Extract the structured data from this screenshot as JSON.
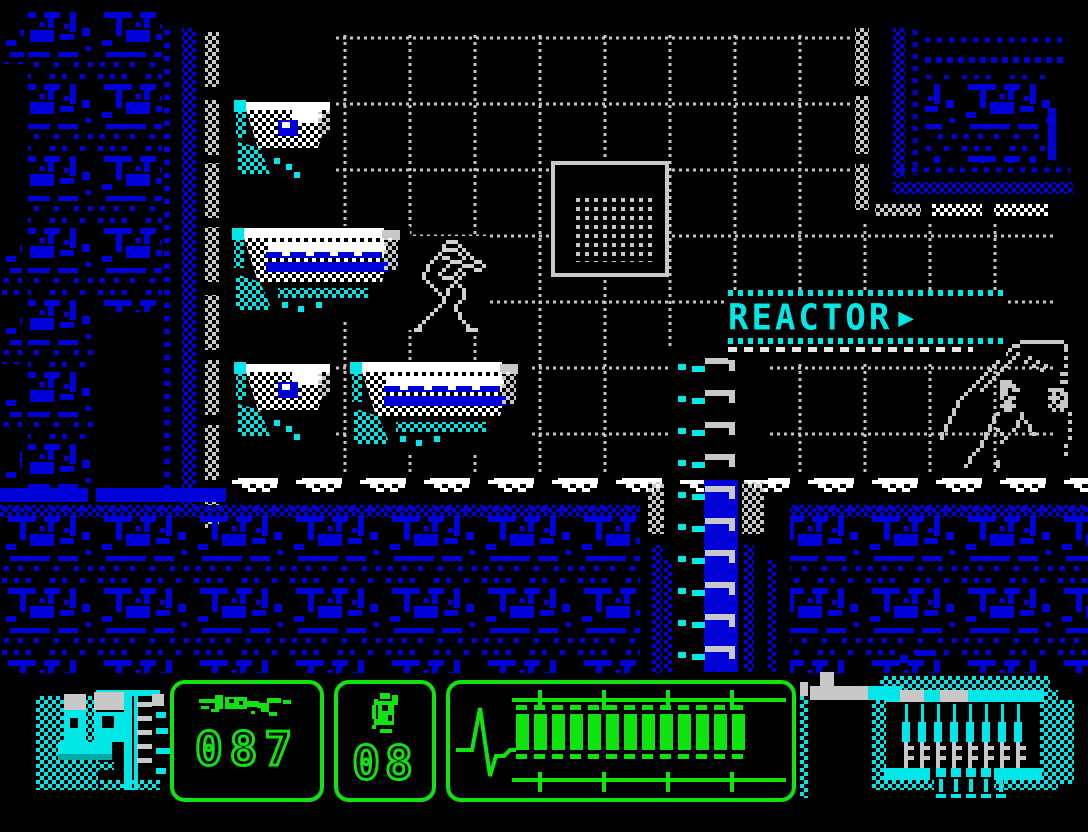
{
  "scene": {
    "sign": {
      "label": "REACTOR",
      "arrow": "▶"
    }
  },
  "hud": {
    "ammo": {
      "icon": "rifle-icon",
      "value": "087"
    },
    "grenades": {
      "icon": "grenade-icon",
      "value": "08"
    },
    "health": {
      "icon": "ekg-icon",
      "segments_filled": 13,
      "segments_total": 16
    }
  },
  "sprites": {
    "player": "soldier-with-rifle",
    "enemy": "alien-creature"
  },
  "colors": {
    "blue": "#0000d8",
    "cyan": "#00e7e7",
    "dark_cyan": "#00a8a8",
    "green": "#0fe40f",
    "gray": "#c8c8c8",
    "white": "#ffffff",
    "black": "#000000"
  }
}
